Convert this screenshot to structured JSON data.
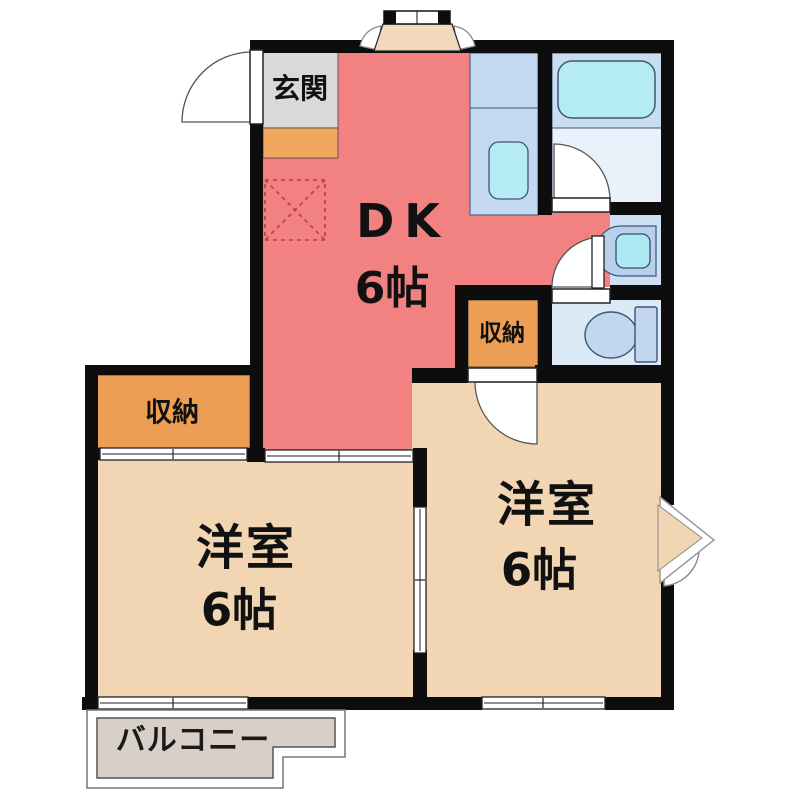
{
  "meta": {
    "type": "apartment-floor-plan",
    "style": "2DK layout drawing"
  },
  "rooms": {
    "entrance": {
      "label": "玄関"
    },
    "dk": {
      "label": "DK",
      "size": "6帖"
    },
    "closet_left": {
      "label": "収納"
    },
    "closet_right": {
      "label": "収納"
    },
    "bedroom_left": {
      "label": "洋室",
      "size": "6帖"
    },
    "bedroom_right": {
      "label": "洋室",
      "size": "6帖"
    },
    "balcony": {
      "label": "バルコニー"
    },
    "bathroom": {
      "label": ""
    },
    "washroom": {
      "label": ""
    },
    "toilet": {
      "label": ""
    }
  },
  "fixtures": [
    "bathtub",
    "kitchen-counter",
    "kitchen-sink",
    "washbasin",
    "toilet-bowl",
    "refrigerator-space",
    "bay-window-top",
    "bay-window-right",
    "entrance-door",
    "bathroom-door",
    "washroom-door",
    "toilet-door",
    "closet-right-door",
    "sliding-door-dk-bedroom",
    "sliding-door-closet",
    "sliding-door-between-bedrooms",
    "window-left",
    "window-right"
  ],
  "colors": {
    "wall": "#0D0D0D",
    "dk_pink": "#F28181",
    "room_beige": "#F2D6B4",
    "entrance_gray": "#D9D9D9",
    "step_orange": "#F0A75E",
    "closet_orange": "#EC9E55",
    "counter_blue": "#C3D8F1",
    "fixture_cyan": "#B5ECF4",
    "wet_floor_blue": "#DCE9F7",
    "bath_upper_blue": "#C9DDF2",
    "bath_lower_blue": "#E9F1FB",
    "fixture_outline": "#3D5671",
    "balcony_gray": "#D8D0C8",
    "dashed_box": "#C23B3B"
  }
}
